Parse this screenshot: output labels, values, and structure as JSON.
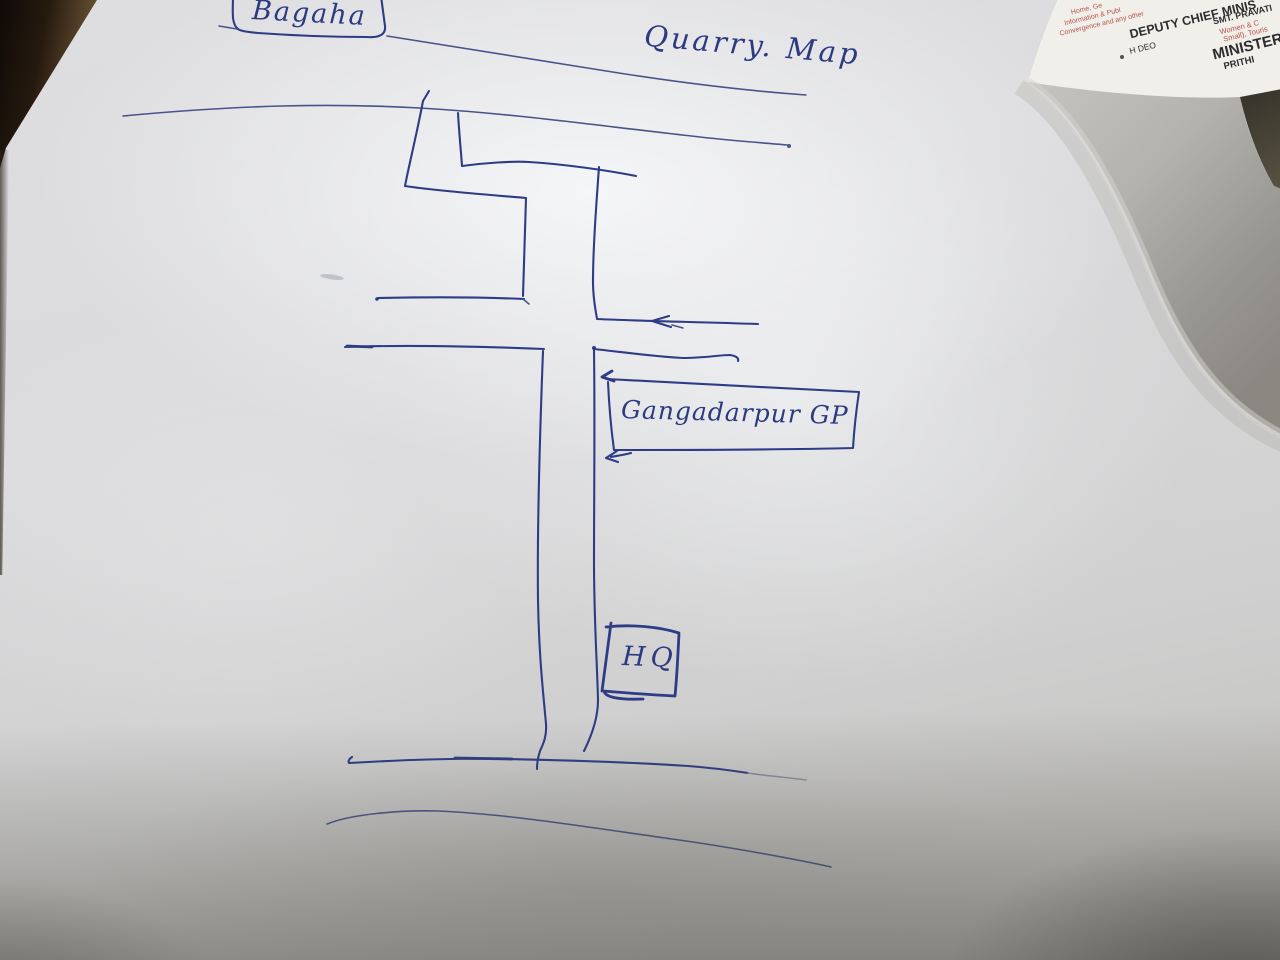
{
  "sketch": {
    "title": "Quarry. Map",
    "origin_label": "Bagaha",
    "gp_label": "Gangadarpur GP",
    "hq_label": "HQ"
  },
  "printed_doc": {
    "lines": [
      "Home, Ge",
      "Information & Publ",
      "Convergence and any other",
      "DEPUTY CHIEF MINIS",
      "SMT. PRAVATI",
      "H DEO",
      "Women & C",
      "Small), Touris",
      "MINISTERS",
      "PRITHI"
    ]
  },
  "colors": {
    "ink_blue": "#2e3c86",
    "doc_red": "#b5524a",
    "doc_black": "#2d2d30"
  }
}
